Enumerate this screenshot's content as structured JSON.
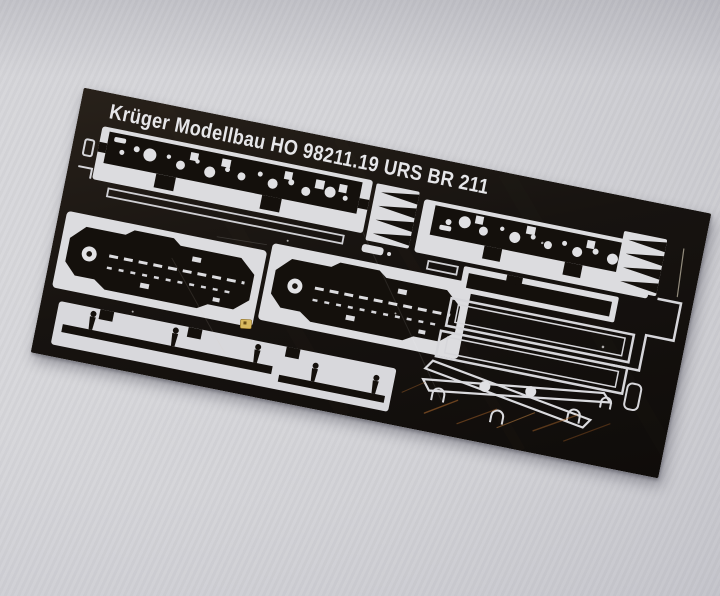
{
  "photo": {
    "description": "Black photo-etched metal detail fret lying tilted on light grey paper",
    "paper_color": "#d4d4d8",
    "sheet_color": "#16110e",
    "etch_line_color": "#dedee1",
    "brass_chip_color": "#d9ba5f",
    "copper_scuff_color": "#b06a2c",
    "rotation_deg": 11.36
  },
  "sheet": {
    "title": "Krüger Modellbau HO 98211.19 URS BR 211",
    "maker": "Krüger Modellbau",
    "gauge": "HO",
    "set_number": "98211.19",
    "series": "URS BR 211"
  }
}
